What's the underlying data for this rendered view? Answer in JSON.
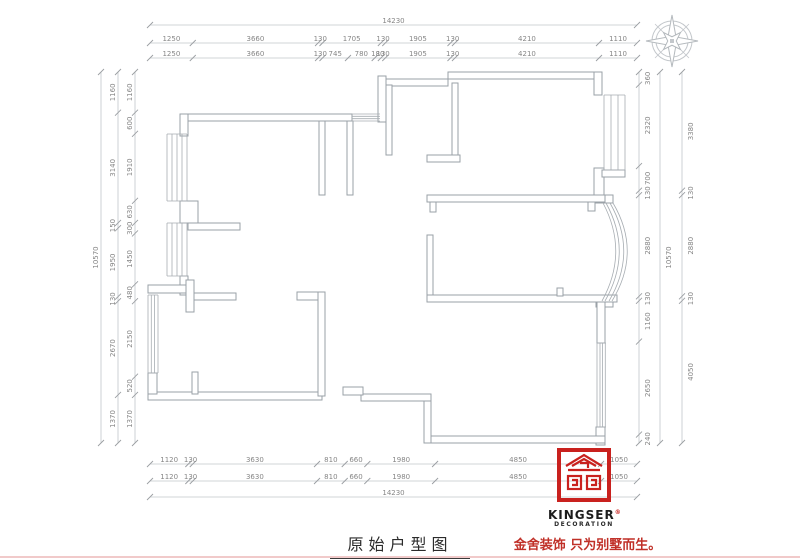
{
  "title": "原始户型图",
  "branding": {
    "logo_line1": "KINGSER",
    "logo_reg": "®",
    "logo_line2": "DECORATION",
    "slogan": "金舍装饰 只为别墅而生。",
    "logo_red": "#c9211e",
    "slogan_red": "#c03028"
  },
  "dimensions": {
    "top_total": [
      "14230"
    ],
    "top_coarse": [
      "1250",
      "3660",
      "130",
      "1705",
      "130",
      "1905",
      "130",
      "4210",
      "1110"
    ],
    "top_fine": [
      "1250",
      "3660",
      "130",
      "745",
      "780",
      "180",
      "130",
      "1905",
      "130",
      "4210",
      "1110"
    ],
    "bottom_coarse": [
      "1120",
      "130",
      "3630",
      "810",
      "660",
      "1980",
      "4850",
      "1050"
    ],
    "bottom_fine": [
      "1120",
      "130",
      "3630",
      "810",
      "660",
      "1980",
      "4850",
      "1050"
    ],
    "bottom_total": [
      "14230"
    ],
    "left_total": [
      "10570"
    ],
    "left_coarse": [
      "1160",
      "3140",
      "150",
      "1950",
      "130",
      "2670",
      "1370"
    ],
    "left_fine": [
      "1160",
      "600",
      "1910",
      "630",
      "300",
      "1450",
      "480",
      "2150",
      "520",
      "1370"
    ],
    "right_fine": [
      "360",
      "2320",
      "700",
      "130",
      "2880",
      "130",
      "1160",
      "2650",
      "240"
    ],
    "right_coarse": [
      "3380",
      "130",
      "2880",
      "130",
      "4050"
    ],
    "right_total": [
      "10570"
    ]
  },
  "colors": {
    "wall": "#9aa1a7",
    "dim_line": "#c2c6ca",
    "dim_text": "#868686"
  }
}
